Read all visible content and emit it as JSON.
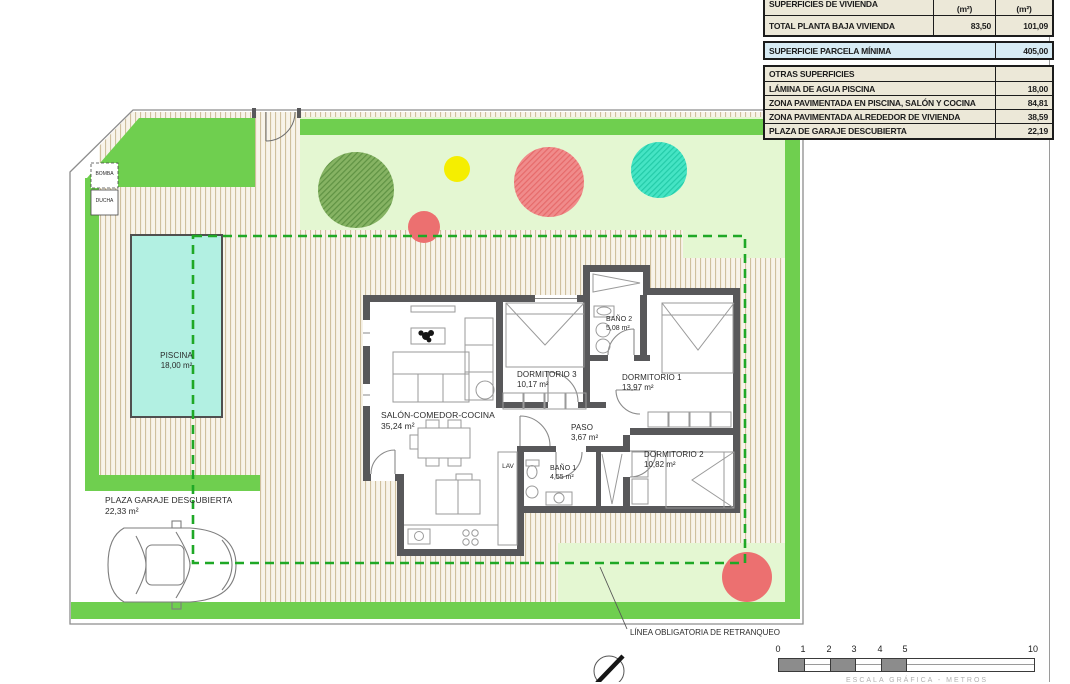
{
  "table": {
    "header": {
      "label": "SUPERFICIES DE VIVIENDA",
      "col1": "(m²)",
      "col2": "(m²)"
    },
    "total_row": {
      "label": "TOTAL PLANTA BAJA VIVIENDA",
      "v1": "83,50",
      "v2": "101,09"
    },
    "parcela_row": {
      "label": "SUPERFICIE PARCELA MÍNIMA",
      "value": "405,00"
    },
    "otras_header": "OTRAS SUPERFICIES",
    "otras_rows": [
      {
        "label": "LÁMINA DE AGUA PISCINA",
        "value": "18,00"
      },
      {
        "label": "ZONA PAVIMENTADA EN PISCINA, SALÓN Y COCINA",
        "value": "84,81"
      },
      {
        "label": "ZONA PAVIMENTADA ALREDEDOR DE VIVIENDA",
        "value": "38,59"
      },
      {
        "label": "PLAZA DE GARAJE DESCUBIERTA",
        "value": "22,19"
      }
    ]
  },
  "plan": {
    "labels": {
      "piscina": {
        "name": "PISCINA",
        "area": "18,00 m²"
      },
      "garaje": {
        "name": "PLAZA GARAJE DESCUBIERTA",
        "area": "22,33 m²"
      },
      "bomba": {
        "name": "BOMBA"
      },
      "ducha": {
        "name": "DUCHA"
      },
      "salon": {
        "name": "SALÓN-COMEDOR-COCINA",
        "area": "35,24 m²"
      },
      "dormitorio3": {
        "name": "DORMITORIO 3",
        "area": "10,17 m²"
      },
      "dormitorio1": {
        "name": "DORMITORIO 1",
        "area": "13,97 m²"
      },
      "dormitorio2": {
        "name": "DORMITORIO 2",
        "area": "10,82 m²"
      },
      "bano2": {
        "name": "BAÑO 2",
        "area": "5,08 m²"
      },
      "bano1": {
        "name": "BAÑO 1",
        "area": "4,55 m²"
      },
      "paso": {
        "name": "PASO",
        "area": "3,67 m²"
      },
      "lav": {
        "name": "LAV"
      }
    },
    "annotations": {
      "retranqueo": "LÍNEA OBLIGATORIA DE RETRANQUEO"
    }
  },
  "scale_bar": {
    "ticks": [
      "0",
      "1",
      "2",
      "3",
      "4",
      "5",
      "10"
    ],
    "caption": "ESCALA GRÁFICA - METROS"
  },
  "colors": {
    "grass": "#6fcf4f",
    "lawn": "#e4f7d2",
    "pool": "#b2f0e2",
    "tree_green": "#7fae5e",
    "tree_red": "#ee7f7f",
    "tree_teal": "#35e0bf",
    "tree_yellow": "#f5ee00",
    "wall": "#58585a",
    "setback_dash": "#1fa826",
    "table_highlight": "#d7ebf4",
    "table_beige": "#ece8d8"
  }
}
